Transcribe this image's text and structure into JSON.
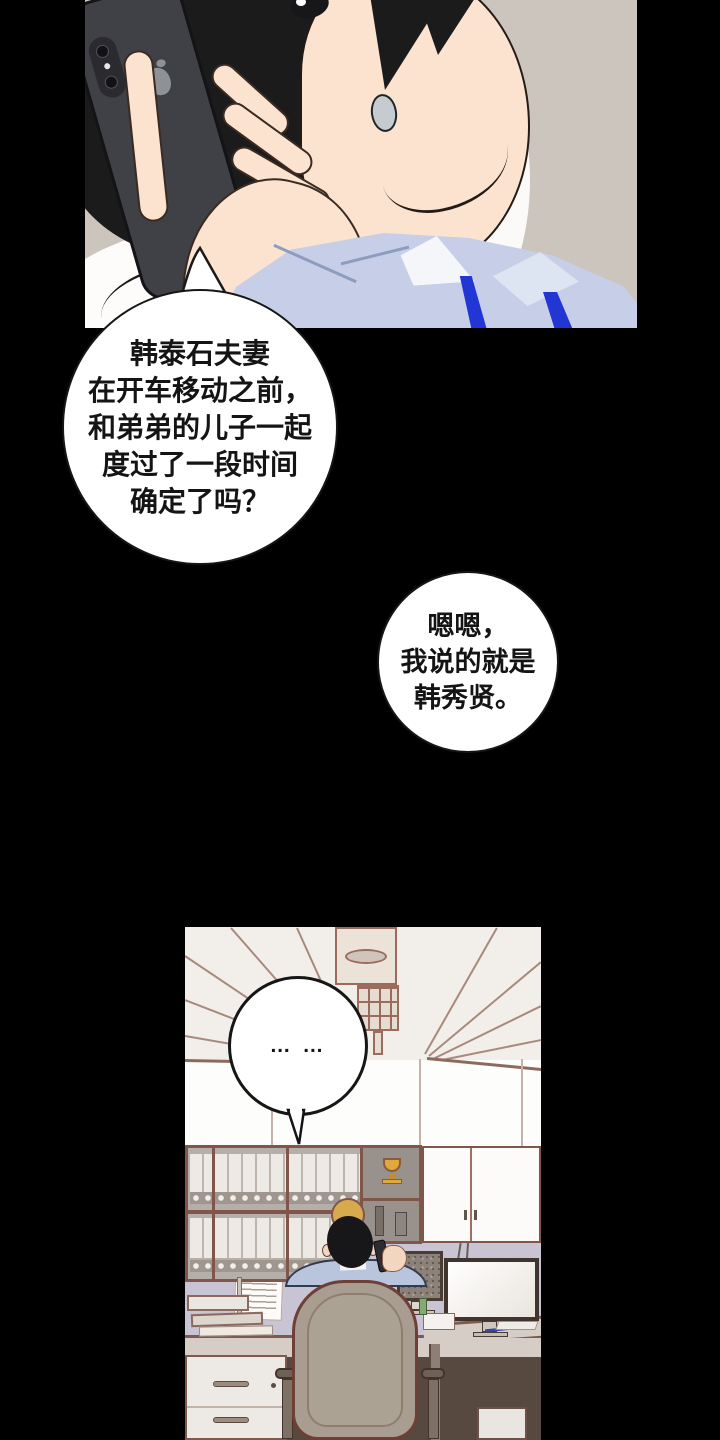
{
  "page": {
    "width": 720,
    "height": 1440,
    "background": "#000000"
  },
  "speech_bubbles": {
    "question": {
      "lines": [
        "韩泰石夫妻",
        "在开车移动之前，",
        "和弟弟的儿子一起",
        "度过了一段时间",
        "确定了吗？"
      ]
    },
    "answer": {
      "lines": [
        "嗯嗯，",
        "我说的就是",
        "韩秀贤。"
      ]
    },
    "silence": {
      "text": "… …"
    }
  },
  "palette": {
    "page_background": "#000000",
    "top_panel_background": "#ccc5be",
    "bubble_fill": "#ffffff",
    "bubble_text": "#141414",
    "skin": "#fce3d0",
    "hair": "#1b1b1c",
    "phone_body": "#404146",
    "shirt": "#c6cfe7",
    "shirt_stripe": "#2136d2",
    "office_ceiling": "#f2efea",
    "office_line": "#9b6b5d",
    "office_partition": "#c8c4d3",
    "shelf_frame": "#80564b",
    "trophy_gold": "#e0a93e",
    "chair": "#a89d90",
    "chair_outline": "#6e4035",
    "desk": "#d6cec6"
  }
}
